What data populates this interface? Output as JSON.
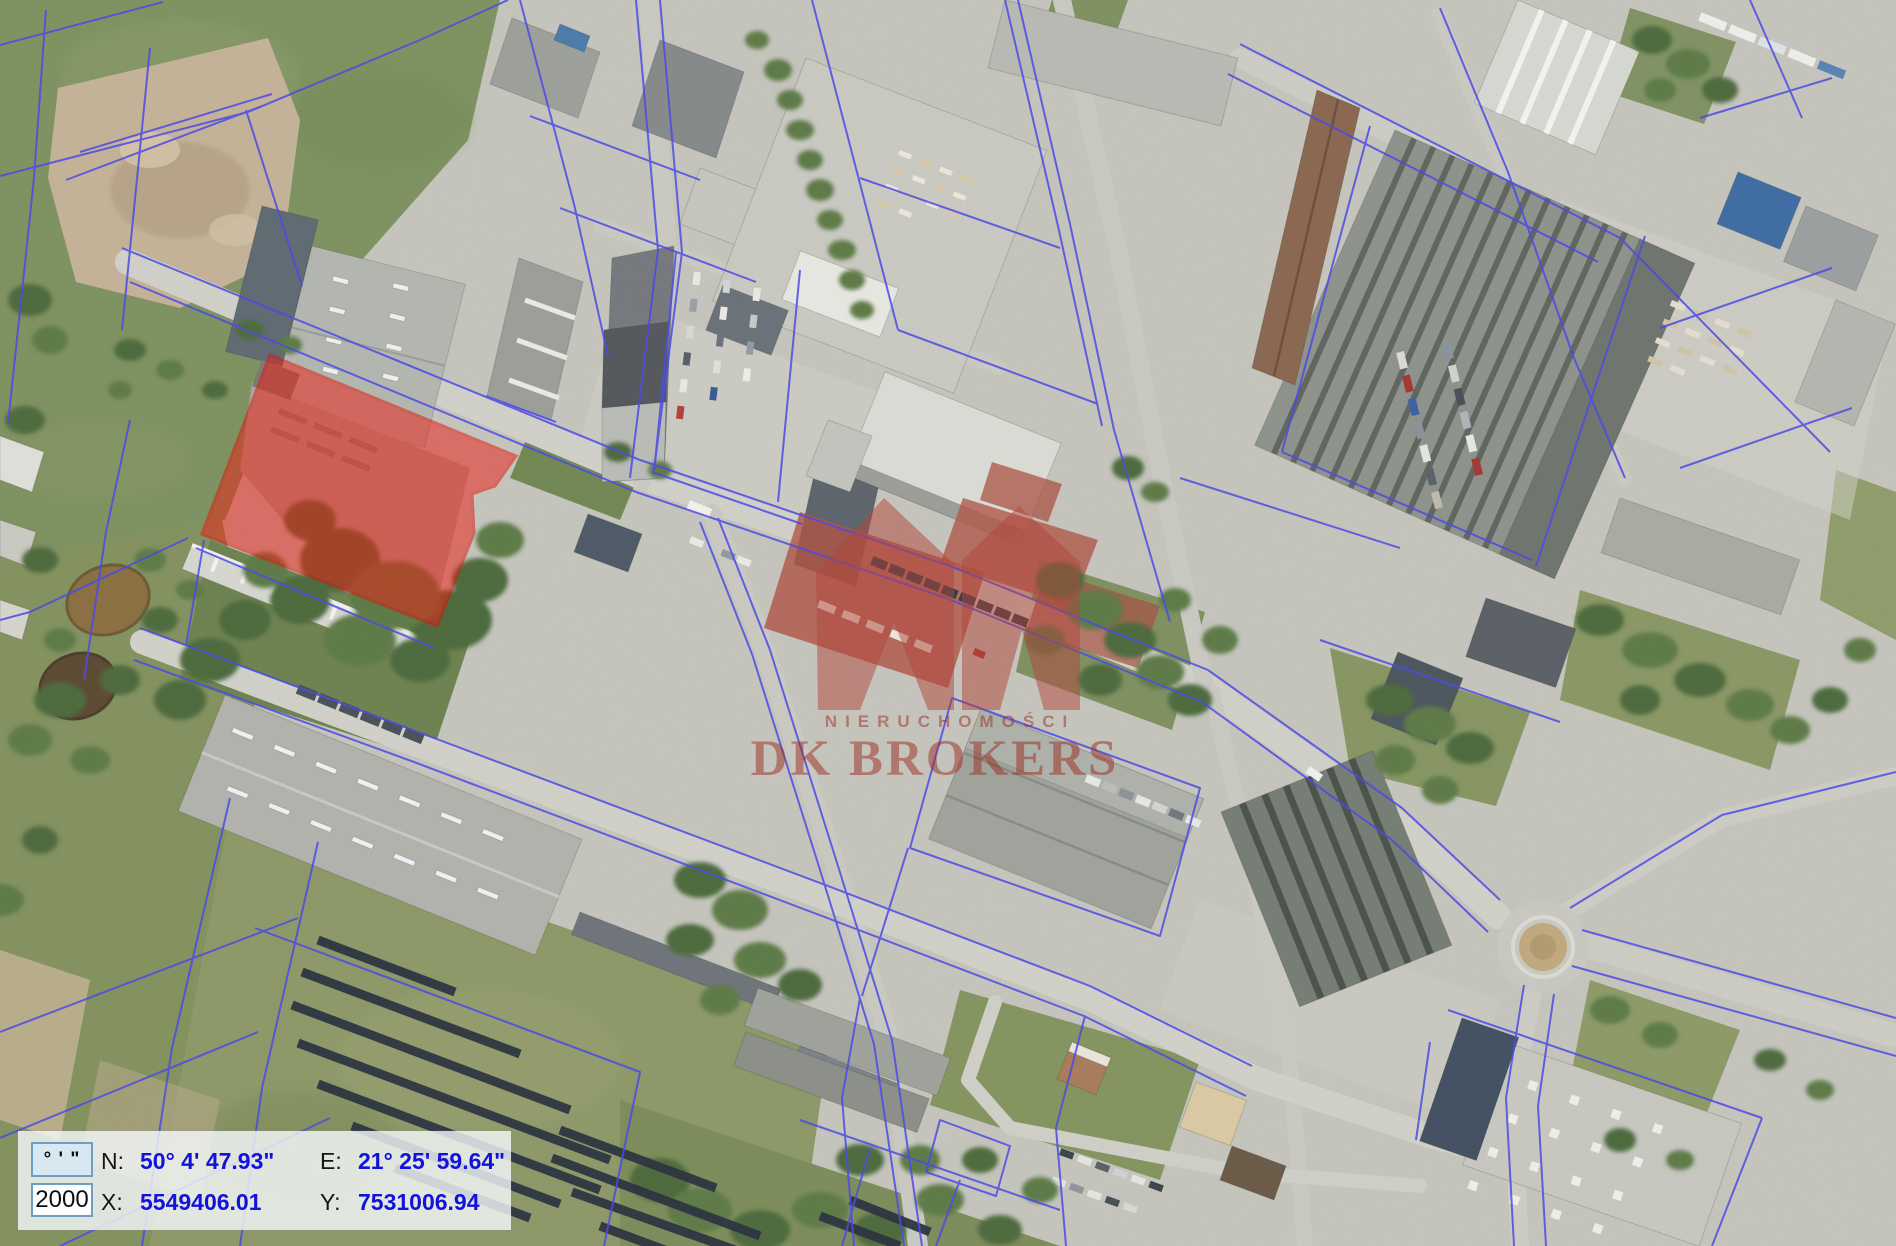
{
  "watermark": {
    "tagline": "NIERUCHOMOŚCI",
    "brand": "DK BROKERS"
  },
  "coordinate_panel": {
    "format_box": "° ' \"",
    "crs_box": "2000",
    "north_label": "N:",
    "north_value": "50° 4' 47.93\"",
    "east_label": "E:",
    "east_value": "21° 25' 59.64\"",
    "x_label": "X:",
    "x_value": "5549406.01",
    "y_label": "Y:",
    "y_value": "7531006.94"
  },
  "map": {
    "colors": {
      "coordinate_value_text": "#1212dd",
      "cadastral_line": "#4a4ae6",
      "selected_parcel_fill": "#ee1f14",
      "selected_parcel_stroke": "#df1409",
      "watermark_red": "#9c2c21"
    }
  }
}
